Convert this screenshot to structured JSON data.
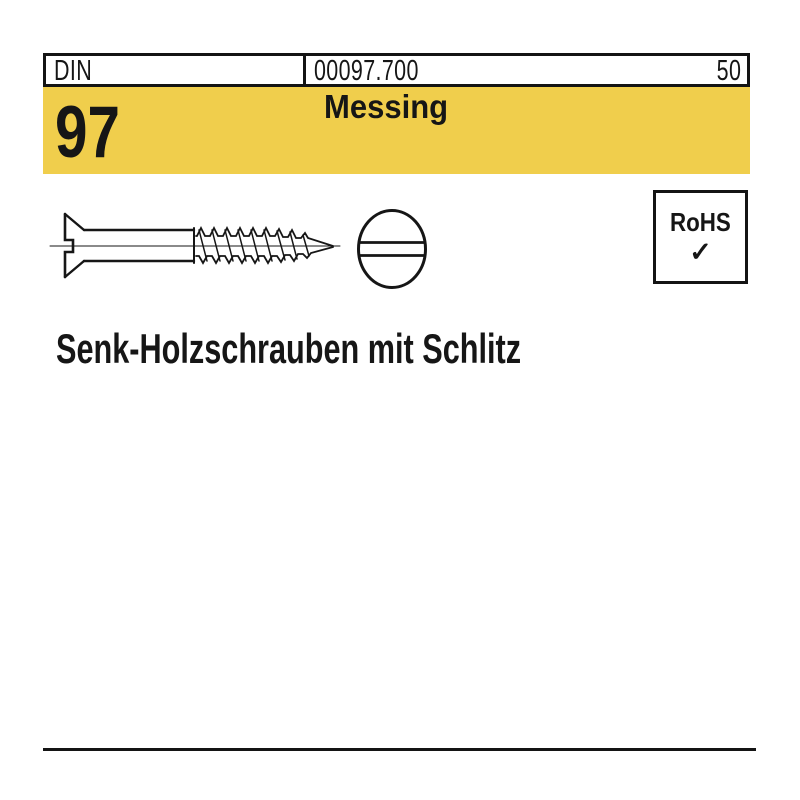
{
  "header": {
    "din_label": "DIN",
    "article_number": "00097.700",
    "page_number": "50",
    "din_number": "97",
    "material": "Messing",
    "banner_color": "#F0CE4C"
  },
  "drawing": {
    "side_view": "countersunk-slotted-wood-screw-side-view",
    "head_view": "slotted-screw-head-front-view",
    "line_color": "#161616"
  },
  "rohs": {
    "label": "RoHS",
    "check_icon": "✓"
  },
  "title": "Senk-Holzschrauben mit Schlitz"
}
